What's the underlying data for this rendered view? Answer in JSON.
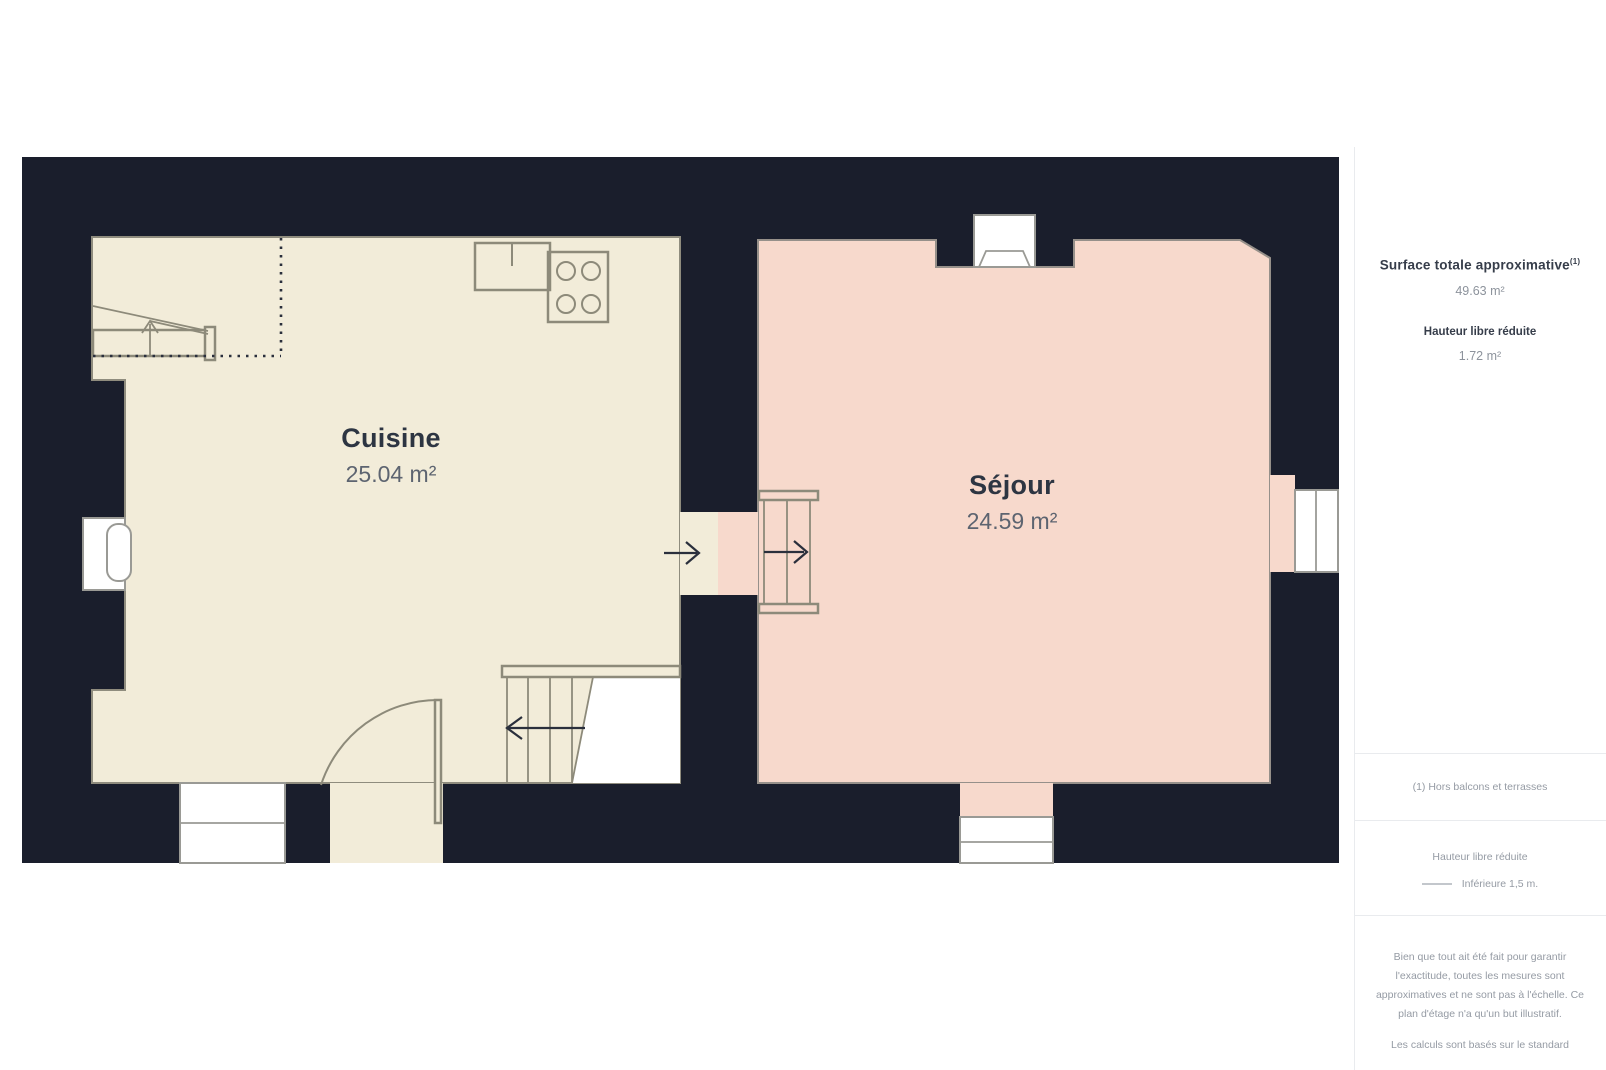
{
  "plan": {
    "rooms": [
      {
        "name": "Cuisine",
        "area": "25.04 m²"
      },
      {
        "name": "Séjour",
        "area": "24.59 m²"
      }
    ]
  },
  "sidebar": {
    "surface_label": "Surface totale approximative",
    "surface_footnote_marker": "(1)",
    "surface_value": "49.63 m²",
    "height_label": "Hauteur libre réduite",
    "height_value": "1.72 m²",
    "footnote": "(1) Hors balcons et terrasses",
    "legend_title": "Hauteur libre réduite",
    "legend_item": "Inférieure 1,5 m.",
    "disclaimer_1": "Bien que tout ait été fait pour garantir l'exactitude, toutes les mesures sont approximatives et ne sont pas à l'échelle. Ce plan d'étage n'a qu'un but illustratif.",
    "disclaimer_2": "Les calculs sont basés sur le standard"
  },
  "colors": {
    "wall": "#1a1e2c",
    "kitchen": "#f2ecd9",
    "sejour": "#f7d9cc",
    "ink": "#2a2f3c",
    "divider": "#e9ebee",
    "text-dark": "#2d3542",
    "text-area": "#5d6470",
    "sb-dark": "#363d4a",
    "sb-gray": "#8d939c",
    "sb-light": "#959ba4"
  }
}
